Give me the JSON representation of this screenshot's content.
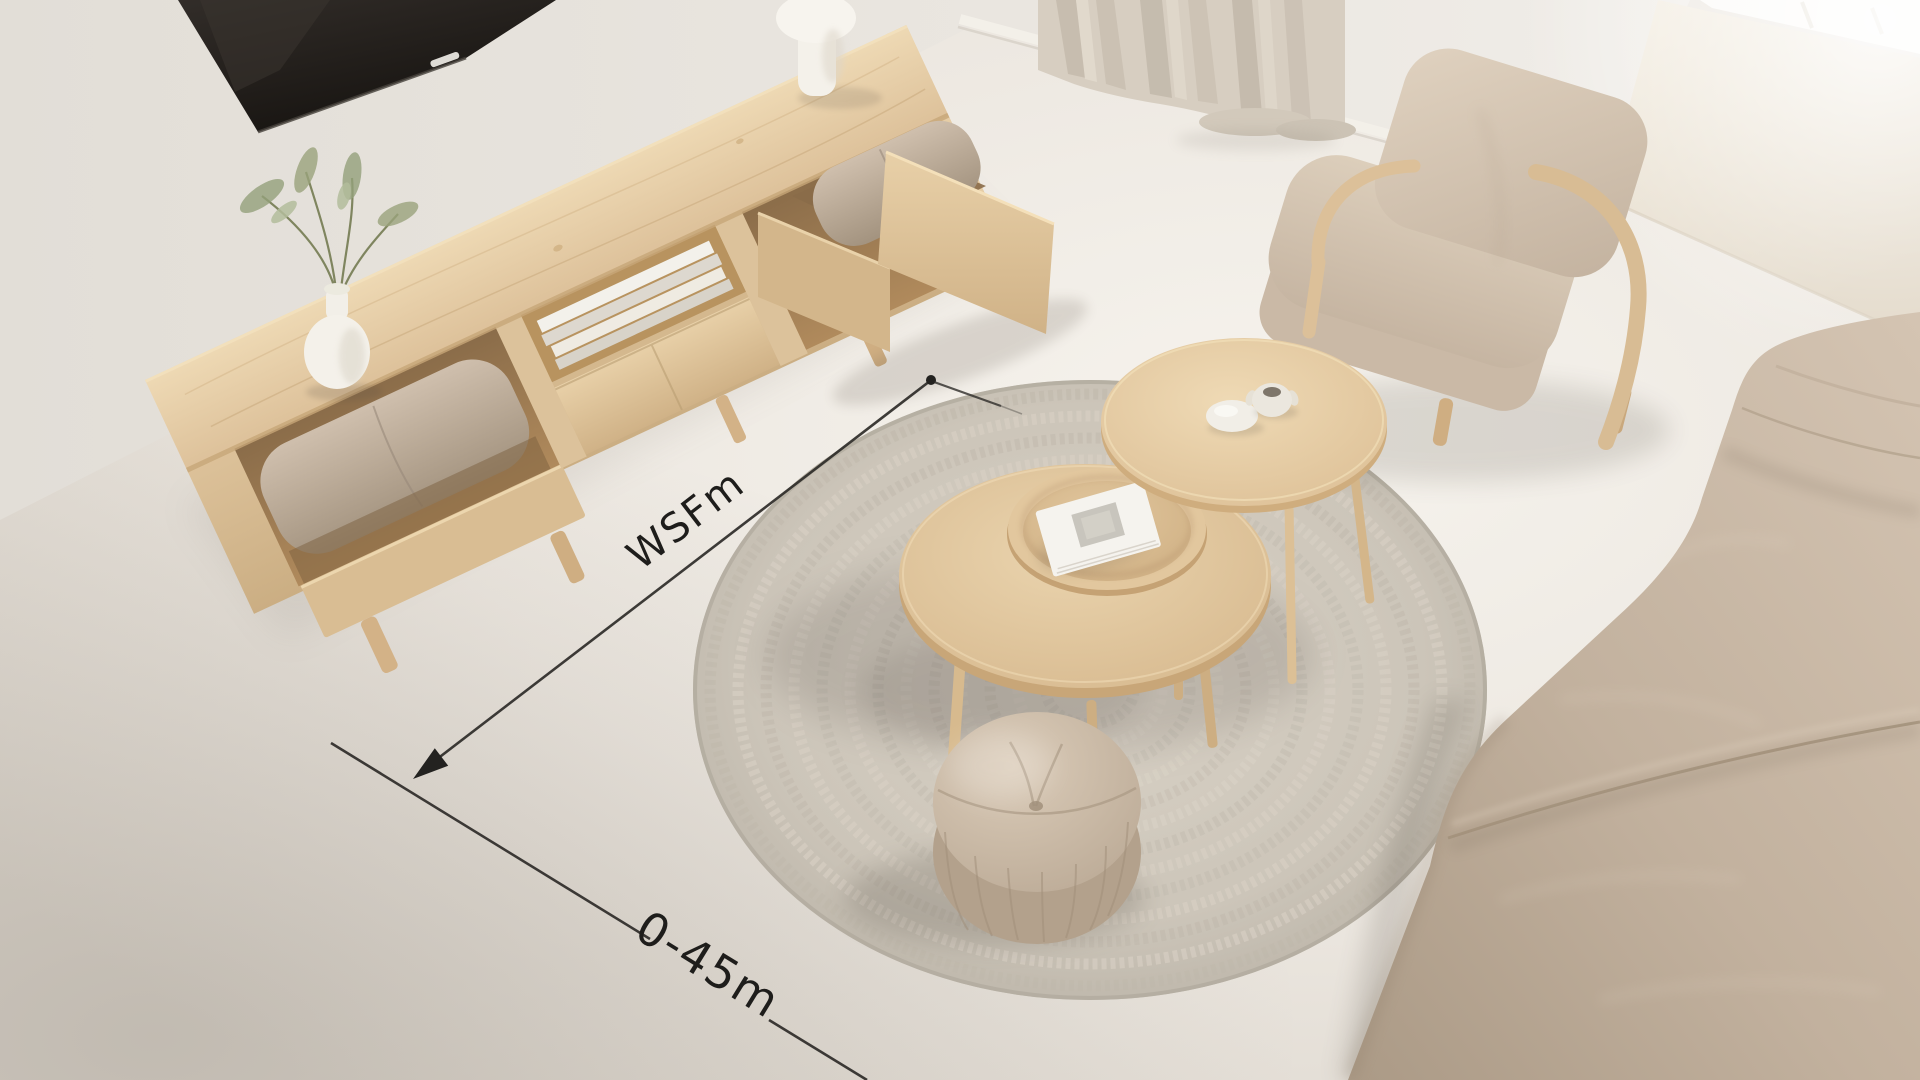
{
  "annotations": {
    "diagonal_dimension": {
      "label": "WSFm",
      "rotation_deg": -37.5
    },
    "bottom_dimension": {
      "label": "0-45m",
      "rotation_deg": 31.5
    },
    "line_color": "#2e2c29",
    "text_color": "#1e1d1b"
  },
  "palette": {
    "wall": "#e8e4de",
    "floor_light": "#f5f2ec",
    "floor_dark": "#ddd7ce",
    "wood_light": "#ecd7b2",
    "wood_mid": "#d9bd94",
    "wood_dark": "#b8956a",
    "cushion_taupe": "#bcab99",
    "armchair_fabric": "#d6c7b5",
    "sofa_fabric": "#c6b5a3",
    "rug_base": "#cec7bb",
    "rug_ring_light": "#d8d1c5",
    "rug_ring_dark": "#bfb8ac",
    "pouf_fabric": "#cdbcaa",
    "curtain": "#d7cec1",
    "tv_screen": "#211d1a",
    "ceramic_white": "#f4f1ea",
    "plant_green": "#94a07b"
  },
  "objects": [
    "wall-mounted-tv",
    "media-console",
    "open-drawer-with-cushion",
    "cubby-cushion",
    "vase-with-branches",
    "table-lamp",
    "magazines",
    "curtain-panel",
    "window-light",
    "armchair",
    "large-coffee-table",
    "tray",
    "book",
    "small-coffee-table",
    "pebble-dish",
    "mini-jar",
    "round-rug",
    "pouf",
    "sofa",
    "dimension-annotations"
  ]
}
